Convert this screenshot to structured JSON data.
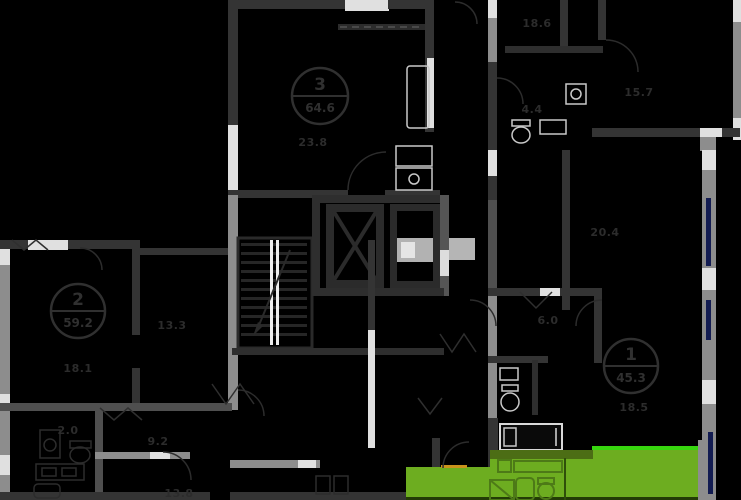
{
  "canvas": {
    "width": 741,
    "height": 500,
    "background": "#000000"
  },
  "palette": {
    "wall_dark": "#343434",
    "wall_mid": "#8d8d8d",
    "wall_light": "#e0e0e0",
    "label_text": "#2c2c2c",
    "highlight_green": "#6dad20",
    "highlight_green_bright": "#37d60e",
    "highlight_green_dark": "#4c6d15",
    "fixture_green_outline": "#4d7a17",
    "door_accent_orange": "#c9921c",
    "window_navy": "#131c52"
  },
  "apartments": [
    {
      "number": "3",
      "total_area": "64.6",
      "badge": {
        "x": 320,
        "y": 96,
        "r": 28
      }
    },
    {
      "number": "2",
      "total_area": "59.2",
      "badge": {
        "x": 78,
        "y": 311,
        "r": 27
      }
    },
    {
      "number": "1",
      "total_area": "45.3",
      "badge": {
        "x": 631,
        "y": 366,
        "r": 27
      }
    }
  ],
  "room_labels": [
    {
      "text": "23.8",
      "x": 313,
      "y": 146
    },
    {
      "text": "18.6",
      "x": 537,
      "y": 27
    },
    {
      "text": "15.7",
      "x": 639,
      "y": 96
    },
    {
      "text": "4.4",
      "x": 532,
      "y": 113
    },
    {
      "text": "20.4",
      "x": 605,
      "y": 236
    },
    {
      "text": "6.0",
      "x": 548,
      "y": 324
    },
    {
      "text": "18.5",
      "x": 634,
      "y": 411
    },
    {
      "text": "13.3",
      "x": 172,
      "y": 329
    },
    {
      "text": "18.1",
      "x": 78,
      "y": 372
    },
    {
      "text": "2.0",
      "x": 68,
      "y": 434
    },
    {
      "text": "9.2",
      "x": 158,
      "y": 445
    },
    {
      "text": "13.8",
      "x": 179,
      "y": 497
    }
  ],
  "highlighted_unit": {
    "state": "selected",
    "fill": "#6dad20",
    "fixtures": [
      "washer-icon",
      "shower-icon",
      "sink-icon",
      "toilet-icon"
    ]
  },
  "core": {
    "stairs": "stairs-icon",
    "elevators": [
      "elevator-icon",
      "elevator-icon"
    ]
  }
}
